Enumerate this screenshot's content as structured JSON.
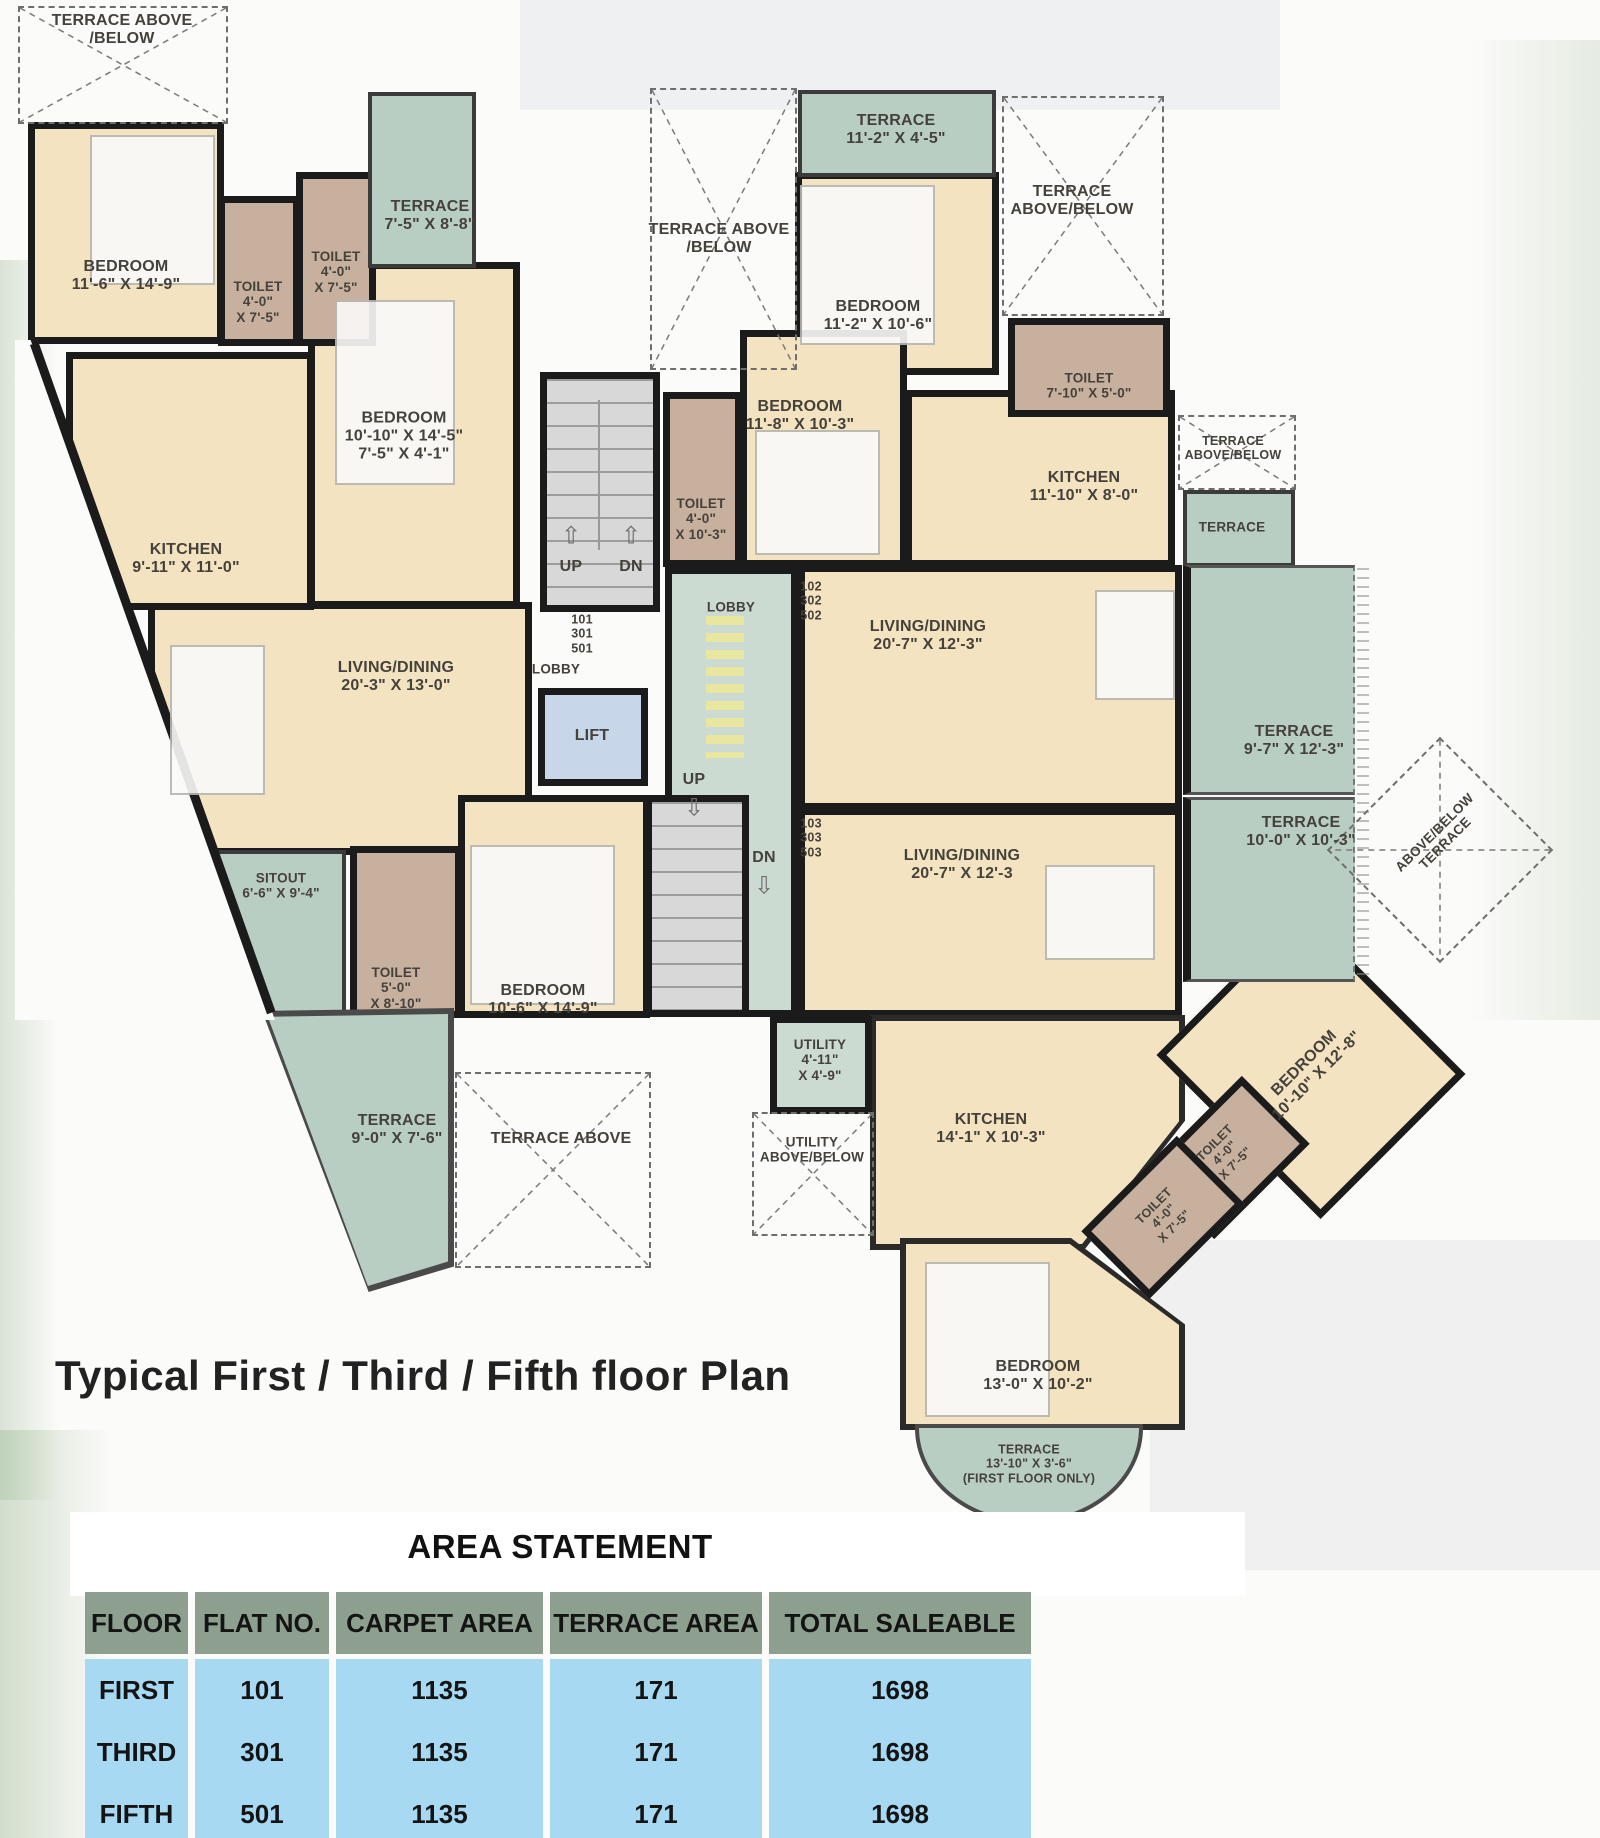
{
  "title": "Typical First / Third / Fifth floor Plan",
  "colors": {
    "wall": "#1b1b1b",
    "room_fill": "#f3e3c0",
    "terrace_fill": "#b9cec3",
    "toilet_fill": "#c8b09e",
    "lobby_fill": "#ccdbd2",
    "lift_fill": "#c7d7e9",
    "stairs_fill": "#d8d8d8",
    "lobby_steps": "#e9e6a0",
    "table_header_bg": "#8da08f",
    "table_row_bg": "#a8d9f2"
  },
  "plan": {
    "flat_numbers": {
      "left": "101\n301\n501",
      "right_upper": "102\n302\n502",
      "right_lower": "103\n303\n503"
    },
    "labels": {
      "terrace_above_tl": "TERRACE ABOVE\n/BELOW",
      "bedroom_1": "BEDROOM\n11'-6\" X 14'-9\"",
      "toilet_1": "TOILET\n4'-0\"\nX 7'-5\"",
      "toilet_2": "TOILET\n4'-0\"\nX 7'-5\"",
      "terrace_1": "TERRACE\n7'-5\" X 8'-8\"",
      "bedroom_2": "BEDROOM\n10'-10\" X 14'-5\"\n7'-5\" X 4'-1\"",
      "kitchen_1": "KITCHEN\n9'-11\" X 11'-0\"",
      "living_1": "LIVING/DINING\n20'-3\" X 13'-0\"",
      "lobby_1": "LOBBY",
      "lobby_2": "LOBBY",
      "lift": "LIFT",
      "up": "UP",
      "dn": "DN",
      "toilet_mid": "TOILET\n4'-0\"\nX 10'-3\"",
      "terrace_above_mid": "TERRACE ABOVE\n/BELOW",
      "terrace_2": "TERRACE\n11'-2\" X 4'-5\"",
      "bedroom_3": "BEDROOM\n11'-2\" X 10'-6\"",
      "terrace_above_tr": "TERRACE\nABOVE/BELOW",
      "toilet_3": "TOILET\n7'-10\" X 5'-0\"",
      "bedroom_4": "BEDROOM\n11'-8\" X 10'-3\"",
      "kitchen_2": "KITCHEN\n11'-10\" X 8'-0\"",
      "terrace_above_sm": "TERRACE\nABOVE/BELOW",
      "terrace_sm": "TERRACE",
      "living_2": "LIVING/DINING\n20'-7\" X 12'-3\"",
      "terrace_3": "TERRACE\n9'-7\" X 12'-3\"",
      "living_3": "LIVING/DINING\n20'-7\" X 12'-3",
      "terrace_4": "TERRACE\n10'-0\" X 10'-3\"",
      "sitout": "SITOUT\n6'-6\" X 9'-4\"",
      "toilet_4": "TOILET\n5'-0\"\nX 8'-10\"",
      "bedroom_5": "BEDROOM\n10'-6\" X 14'-9\"",
      "terrace_bl": "TERRACE\n9'-0\" X 7'-6\"",
      "terrace_above_bl": "TERRACE ABOVE",
      "utility": "UTILITY\n4'-11\"\nX 4'-9\"",
      "utility_above": "UTILITY\nABOVE/BELOW",
      "kitchen_3": "KITCHEN\n14'-1\" X 10'-3\"",
      "bedroom_6": "BEDROOM\n10'-10\" X 12'-8\"",
      "toilet_5": "TOILET\n4'-0\"\nX 7'-5\"",
      "toilet_6": "TOILET\n4'-0\"\nX 7'-5\"",
      "terrace_above_rot": "ABOVE/BELOW\nTERRACE",
      "bedroom_7": "BEDROOM\n13'-0\" X 10'-2\"",
      "terrace_5": "TERRACE\n13'-10\" X 3'-6\"\n(FIRST FLOOR ONLY)"
    }
  },
  "area_statement": {
    "title": "AREA STATEMENT",
    "columns": [
      "FLOOR",
      "FLAT NO.",
      "CARPET AREA",
      "TERRACE AREA",
      "TOTAL SALEABLE"
    ],
    "rows": [
      [
        "FIRST",
        "101",
        "1135",
        "171",
        "1698"
      ],
      [
        "THIRD",
        "301",
        "1135",
        "171",
        "1698"
      ],
      [
        "FIFTH",
        "501",
        "1135",
        "171",
        "1698"
      ]
    ]
  }
}
